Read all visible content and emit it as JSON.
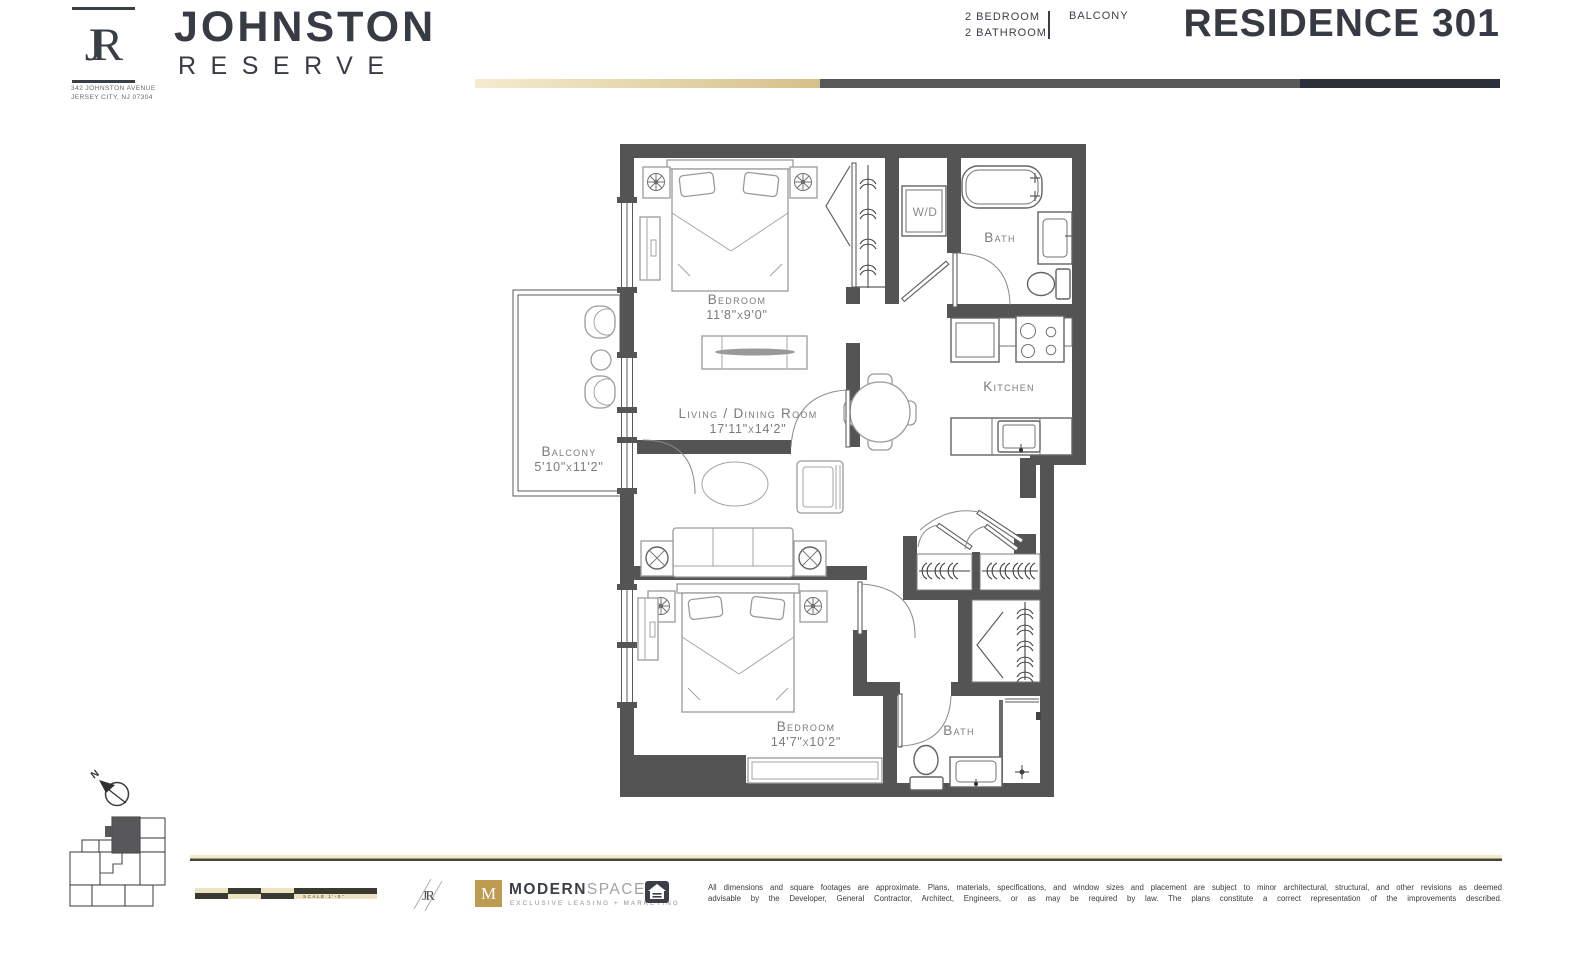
{
  "brand": {
    "monogram": "JR",
    "name": "JOHNSTON",
    "subname": "RESERVE",
    "address_line1": "342 JOHNSTON AVENUE",
    "address_line2": "JERSEY CITY, NJ 07304"
  },
  "header": {
    "spec_line1": "2 BEDROOM",
    "spec_line2": "2 BATHROOM",
    "feature": "BALCONY",
    "title": "RESIDENCE 301"
  },
  "floorplan": {
    "bedroom1_label": "Bedroom",
    "bedroom1_dims": "11'8\"x9'0\"",
    "living_label": "Living / Dining Room",
    "living_dims": "17'11\"x14'2\"",
    "balcony_label": "Balcony",
    "balcony_dims": "5'10\"x11'2\"",
    "bedroom2_label": "Bedroom",
    "bedroom2_dims": "14'7\"x10'2\"",
    "kitchen_label": "Kitchen",
    "bath1_label": "Bath",
    "bath2_label": "Bath",
    "wd_label": "W/D",
    "compass_label": "N"
  },
  "footer": {
    "scale_label": "SCALE 1'-0\"",
    "mini_monogram": "JR",
    "agency_initial": "M",
    "agency_name_bold": "MODERN",
    "agency_name_light": "SPACES",
    "agency_tagline": "EXCLUSIVE LEASING + MARKETING",
    "disclaimer_line1": "All dimensions and square footages are approximate. Plans, materials, specifications, and window sizes and placement are subject to minor architectural, structural, and other revisions as deemed",
    "disclaimer_line2": "advisable by the Developer, General Contractor, Architect, Engineers, or as may be required by law. The plans constitute a correct representation of the improvements described."
  },
  "colors": {
    "wall": "#545454",
    "accent_tan": "#d8c48c",
    "bar_gray": "#595959",
    "bar_dark": "#2c3038",
    "text_dark": "#363b44",
    "label_gray": "#7b7b7b",
    "gold": "#bd9b50"
  }
}
